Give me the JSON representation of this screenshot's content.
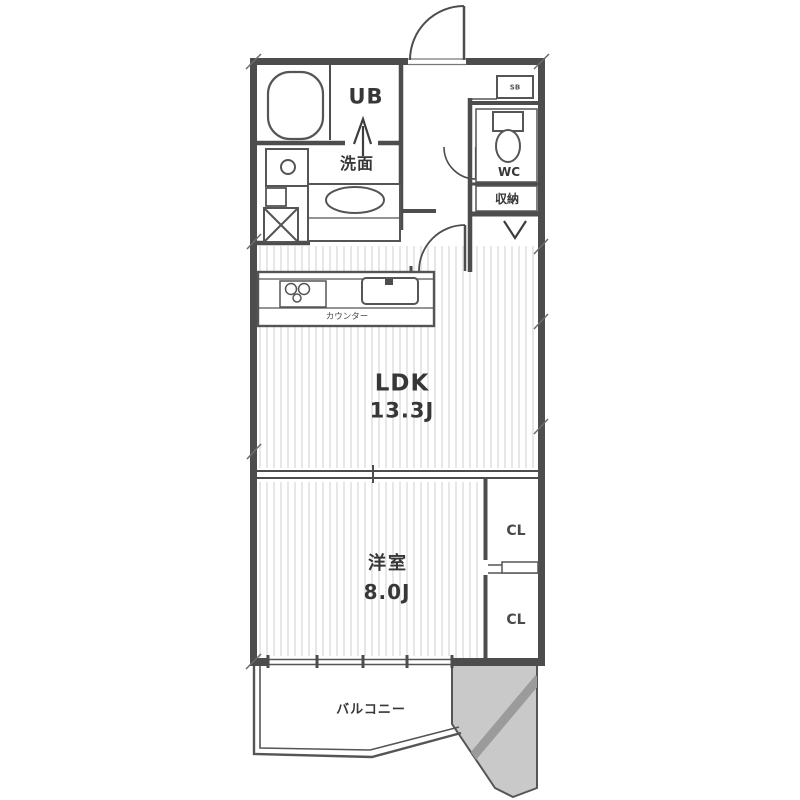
{
  "floorplan": {
    "type": "apartment-floor-plan",
    "rooms": {
      "ldk": {
        "label": "LDK",
        "area": "13.3J"
      },
      "bedroom": {
        "label": "洋室",
        "area": "8.0J"
      },
      "balcony": {
        "label": "バルコニー"
      },
      "unit_bath": {
        "label": "UB"
      },
      "washroom": {
        "label": "洗面"
      },
      "wc": {
        "label": "WC"
      },
      "storage": {
        "label": "収納"
      },
      "shoe_box": {
        "label": "SB"
      },
      "closet_upper": {
        "label": "CL"
      },
      "closet_lower": {
        "label": "CL"
      },
      "kitchen_counter": {
        "label": "カウンター"
      }
    },
    "colors": {
      "wall": "#4d4d4d",
      "fixture_line": "#555555",
      "shaded_area": "#c9c9c9",
      "shaded_band": "#9b9b9b",
      "floor_stripe": "#e7e7e7",
      "text": "#373737",
      "background": "#ffffff"
    }
  }
}
